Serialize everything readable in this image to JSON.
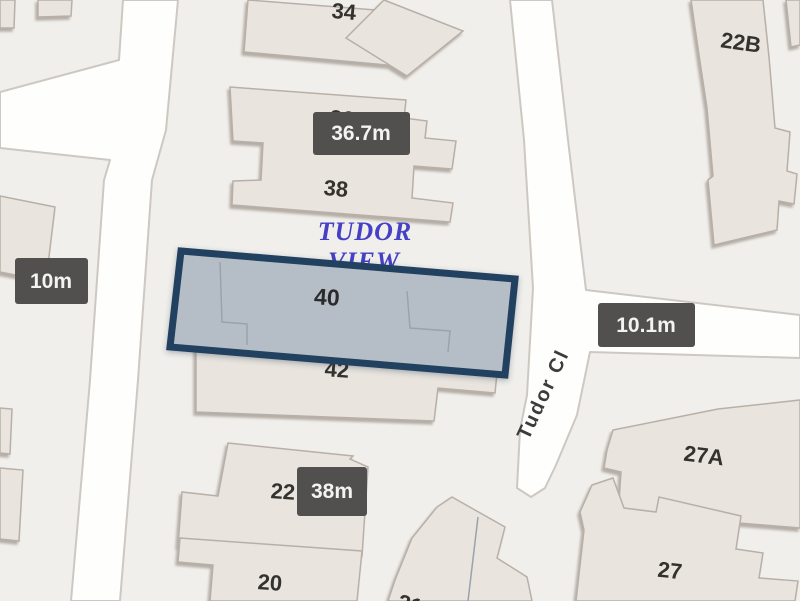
{
  "map": {
    "street": {
      "name": "Tudor Cl"
    },
    "place": {
      "line1": "TUDOR",
      "line2": "VIEW"
    },
    "selected_building": {
      "number": "40"
    },
    "buildings": {
      "n34": "34",
      "n36": "36",
      "n38": "38",
      "n42": "42",
      "n22": "22",
      "n20": "20",
      "n21": "21",
      "n22b": "22B",
      "n27a": "27A",
      "n27": "27"
    },
    "measurements": {
      "left": "10m",
      "top": "36.7m",
      "right": "10.1m",
      "bottom": "38m"
    },
    "colors": {
      "highlight_fill": "#b5bec6",
      "highlight_border": "#23405e",
      "tooltip_bg": "#51504e",
      "tooltip_text": "#f4f3f2",
      "road": "#fefefd",
      "block": "#f1efeb",
      "building": "#e9e4de",
      "place_label": "#4540c6",
      "number_text": "#34322f"
    }
  }
}
